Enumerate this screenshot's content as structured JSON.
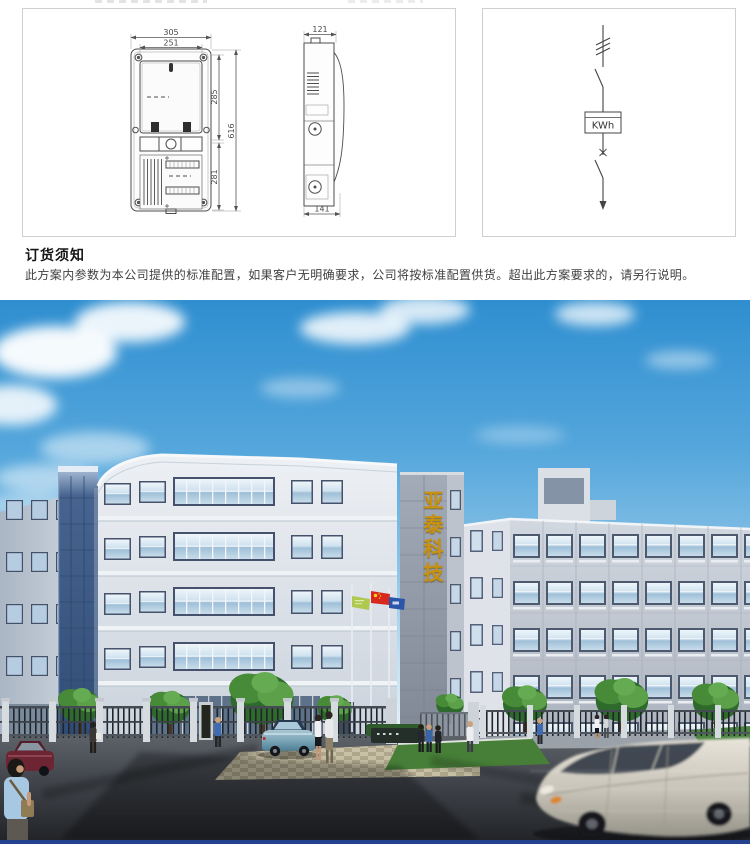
{
  "drawings": {
    "front_view": {
      "width_outer": "305",
      "width_inner": "251",
      "height_upper": "285",
      "height_lower": "281",
      "height_total": "616"
    },
    "side_view": {
      "depth_top": "121",
      "depth_bottom": "141"
    }
  },
  "circuit": {
    "meter_label": "KWh"
  },
  "notice": {
    "title": "订货须知",
    "body": "此方案内参数为本公司提供的标准配置，如果客户无明确要求，公司将按标准配置供货。超出此方案要求的，请另行说明。"
  },
  "photo": {
    "sign_text": "亚泰科技",
    "colors": {
      "sky_top": "#2f8ed0",
      "sky_horizon": "#f3f9fd",
      "sign_gold": "#c8920f",
      "slab_blue": "#3f5e8c",
      "flag_green": "#aec94f",
      "flag_red": "#d8271d",
      "flag_blue": "#2b55a8",
      "footer_bar": "#24418f"
    }
  }
}
